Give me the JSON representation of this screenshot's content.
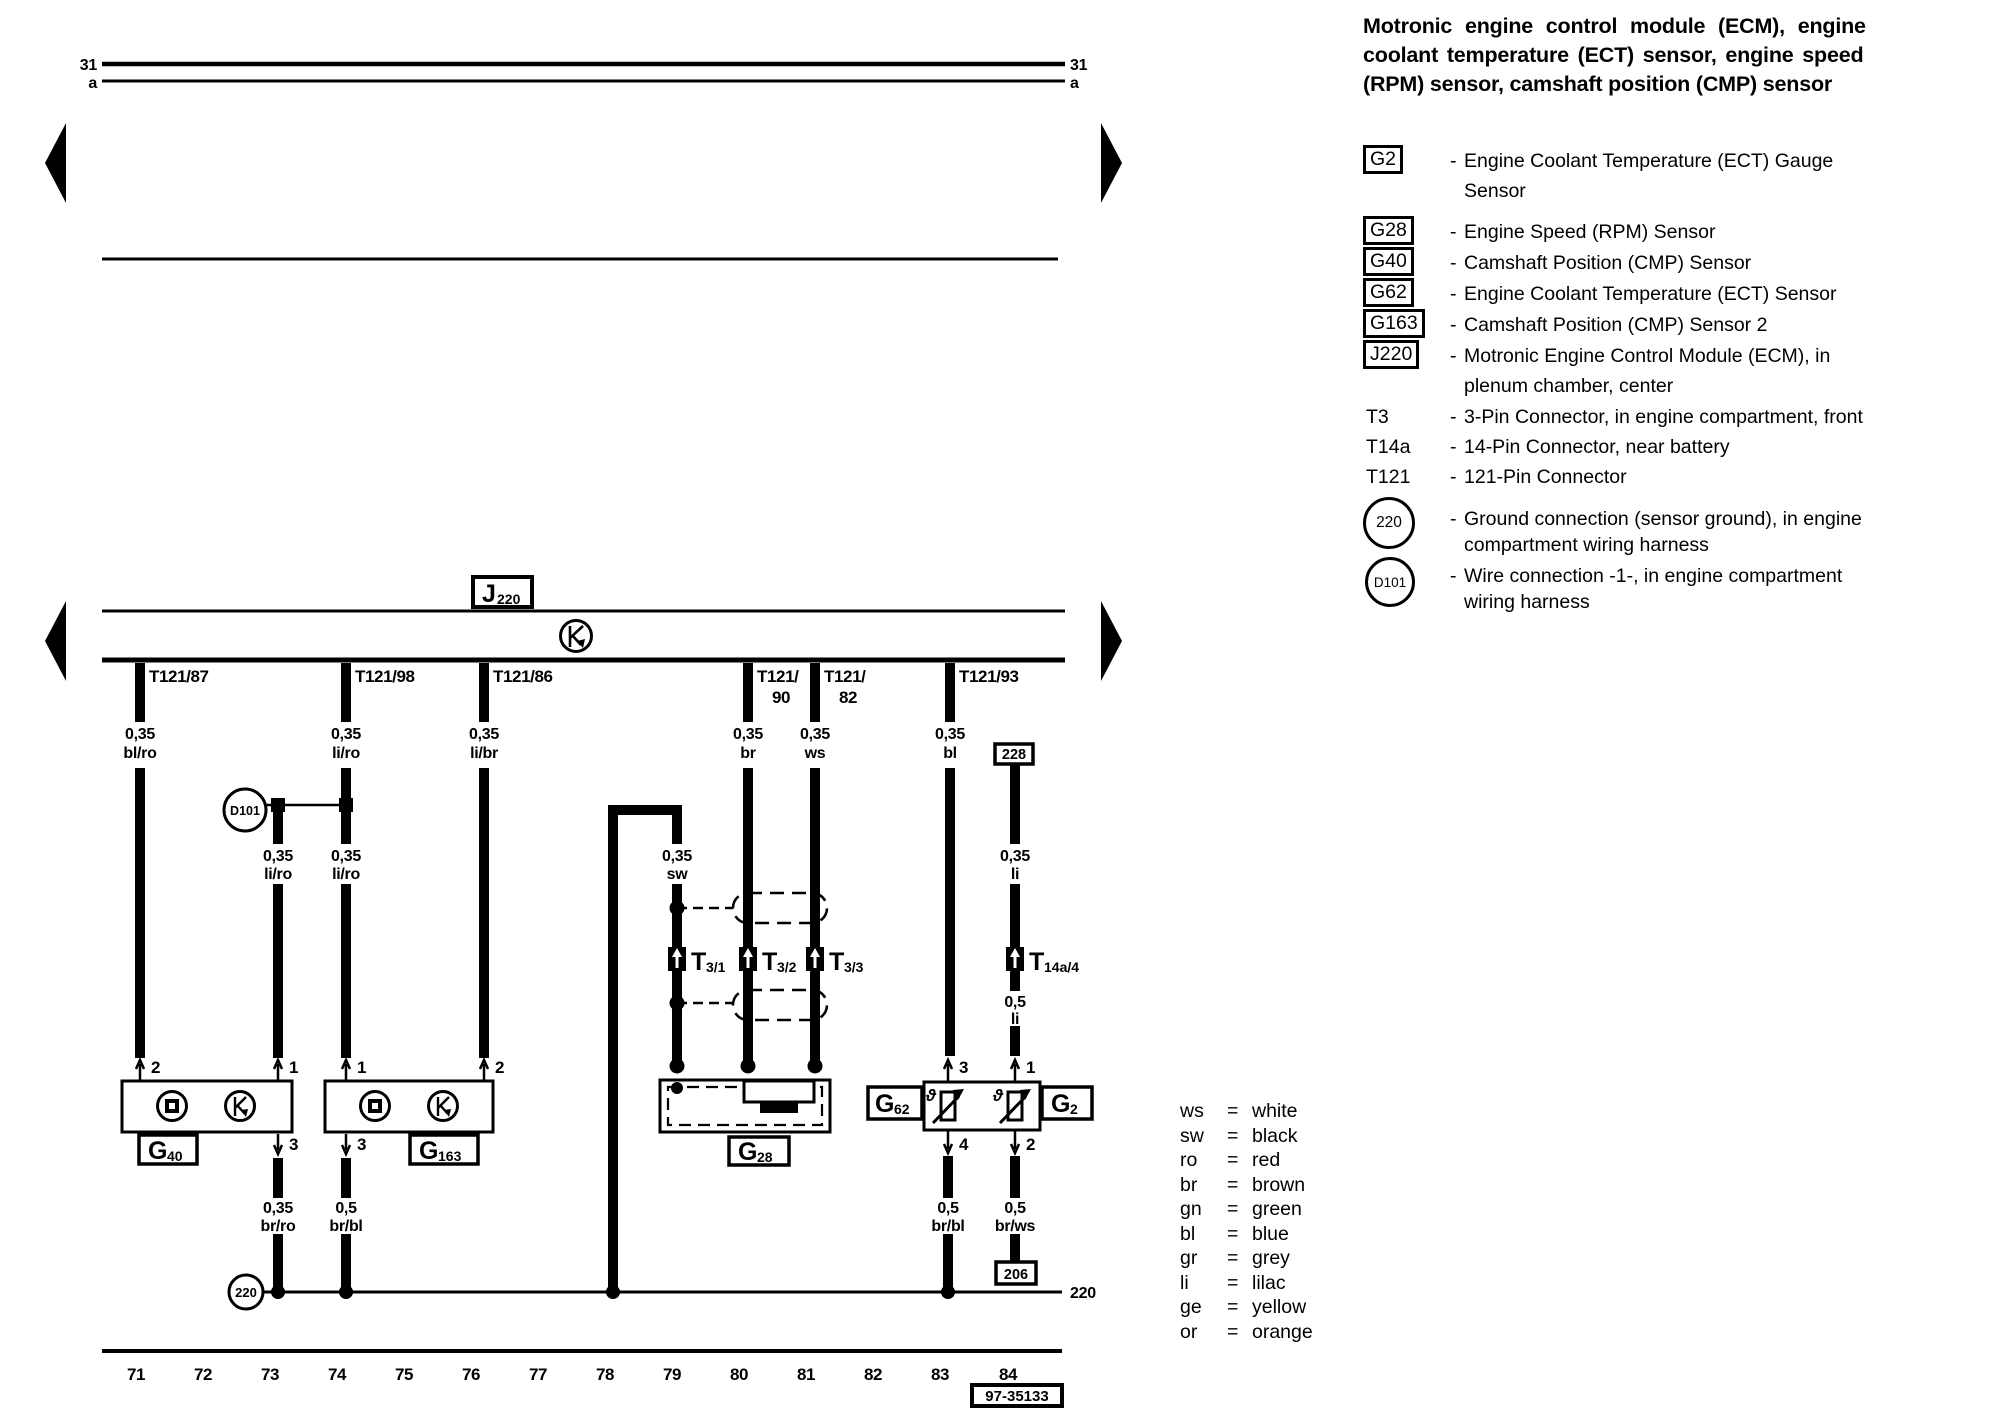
{
  "title": {
    "line1": "Motronic engine control module (ECM), engine",
    "line2": "coolant temperature (ECT) sensor, engine speed",
    "line3": "(RPM) sensor, camshaft position (CMP) sensor"
  },
  "legend": {
    "dash": "-",
    "g2": {
      "code": "G2",
      "desc1": "Engine Coolant Temperature (ECT) Gauge",
      "desc2": "Sensor"
    },
    "g28": {
      "code": "G28",
      "desc": "Engine Speed (RPM) Sensor"
    },
    "g40": {
      "code": "G40",
      "desc": "Camshaft Position (CMP) Sensor"
    },
    "g62": {
      "code": "G62",
      "desc": "Engine Coolant Temperature (ECT) Sensor"
    },
    "g163": {
      "code": "G163",
      "desc": "Camshaft Position (CMP) Sensor 2"
    },
    "j220": {
      "code": "J220",
      "desc1": "Motronic Engine Control Module (ECM), in",
      "desc2": "plenum chamber, center"
    },
    "t3": {
      "code": "T3",
      "desc": "3-Pin Connector, in engine compartment, front"
    },
    "t14a": {
      "code": "T14a",
      "desc": "14-Pin Connector, near battery"
    },
    "t121": {
      "code": "T121",
      "desc": "121-Pin Connector"
    },
    "gnd220": {
      "code": "220",
      "desc1": "Ground connection (sensor ground), in engine",
      "desc2": "compartment wiring harness"
    },
    "d101": {
      "code": "D101",
      "desc1": "Wire connection -1-, in engine compartment",
      "desc2": "wiring harness"
    }
  },
  "color_key": [
    {
      "abbr": "ws",
      "name": "white"
    },
    {
      "abbr": "sw",
      "name": "black"
    },
    {
      "abbr": "ro",
      "name": "red"
    },
    {
      "abbr": "br",
      "name": "brown"
    },
    {
      "abbr": "gn",
      "name": "green"
    },
    {
      "abbr": "bl",
      "name": "blue"
    },
    {
      "abbr": "gr",
      "name": "grey"
    },
    {
      "abbr": "li",
      "name": "lilac"
    },
    {
      "abbr": "ge",
      "name": "yellow"
    },
    {
      "abbr": "or",
      "name": "orange"
    }
  ],
  "color_key_eq": "=",
  "rails": {
    "r31": "31",
    "ra": "a"
  },
  "diagram": {
    "theta": "ϑ",
    "j220": {
      "main": "J",
      "sub": "220"
    },
    "ecm_pins": {
      "p87": "T121/87",
      "p98": "T121/98",
      "p86": "T121/86",
      "p90l1": "T121/",
      "p90l2": "90",
      "p82l1": "T121/",
      "p82l2": "82",
      "p93": "T121/93"
    },
    "wire_labels": {
      "w87": {
        "size": "0,35",
        "color": "bl/ro"
      },
      "w98": {
        "size": "0,35",
        "color": "li/ro"
      },
      "w86": {
        "size": "0,35",
        "color": "li/br"
      },
      "w90": {
        "size": "0,35",
        "color": "br"
      },
      "w82": {
        "size": "0,35",
        "color": "ws"
      },
      "w93": {
        "size": "0,35",
        "color": "bl"
      },
      "d101l": {
        "size": "0,35",
        "color": "li/ro"
      },
      "d101r": {
        "size": "0,35",
        "color": "li/ro"
      },
      "sw": {
        "size": "0,35",
        "color": "sw"
      },
      "li_upper": {
        "size": "0,35",
        "color": "li"
      },
      "li_lower": {
        "size": "0,5",
        "color": "li"
      },
      "g40p3": {
        "size": "0,35",
        "color": "br/ro"
      },
      "g163p3": {
        "size": "0,5",
        "color": "br/bl"
      },
      "g62p4": {
        "size": "0,5",
        "color": "br/bl"
      },
      "g2p2": {
        "size": "0,5",
        "color": "br/ws"
      }
    },
    "connectors": {
      "t31": {
        "main": "T",
        "sub": "3/1"
      },
      "t32": {
        "main": "T",
        "sub": "3/2"
      },
      "t33": {
        "main": "T",
        "sub": "3/3"
      },
      "t14a4": {
        "main": "T",
        "sub": "14a/4"
      }
    },
    "boxes": {
      "b228": "228",
      "b206": "206",
      "ref": "97-35133"
    },
    "circles": {
      "d101": "D101",
      "gnd220": "220"
    },
    "gnd_bus_label": "220",
    "components": {
      "g40": {
        "main": "G",
        "sub": "40"
      },
      "g163": {
        "main": "G",
        "sub": "163"
      },
      "g28": {
        "main": "G",
        "sub": "28"
      },
      "g62": {
        "main": "G",
        "sub": "62"
      },
      "g2": {
        "main": "G",
        "sub": "2"
      }
    },
    "pins": {
      "g40_2": "2",
      "g40_1": "1",
      "g163_1": "1",
      "g163_2": "2",
      "g62_3": "3",
      "g2_1": "1",
      "g40_3": "3",
      "g163_3": "3",
      "g62_4": "4",
      "g2_2": "2"
    },
    "tracks": [
      "71",
      "72",
      "73",
      "74",
      "75",
      "76",
      "77",
      "78",
      "79",
      "80",
      "81",
      "82",
      "83",
      "84"
    ]
  }
}
